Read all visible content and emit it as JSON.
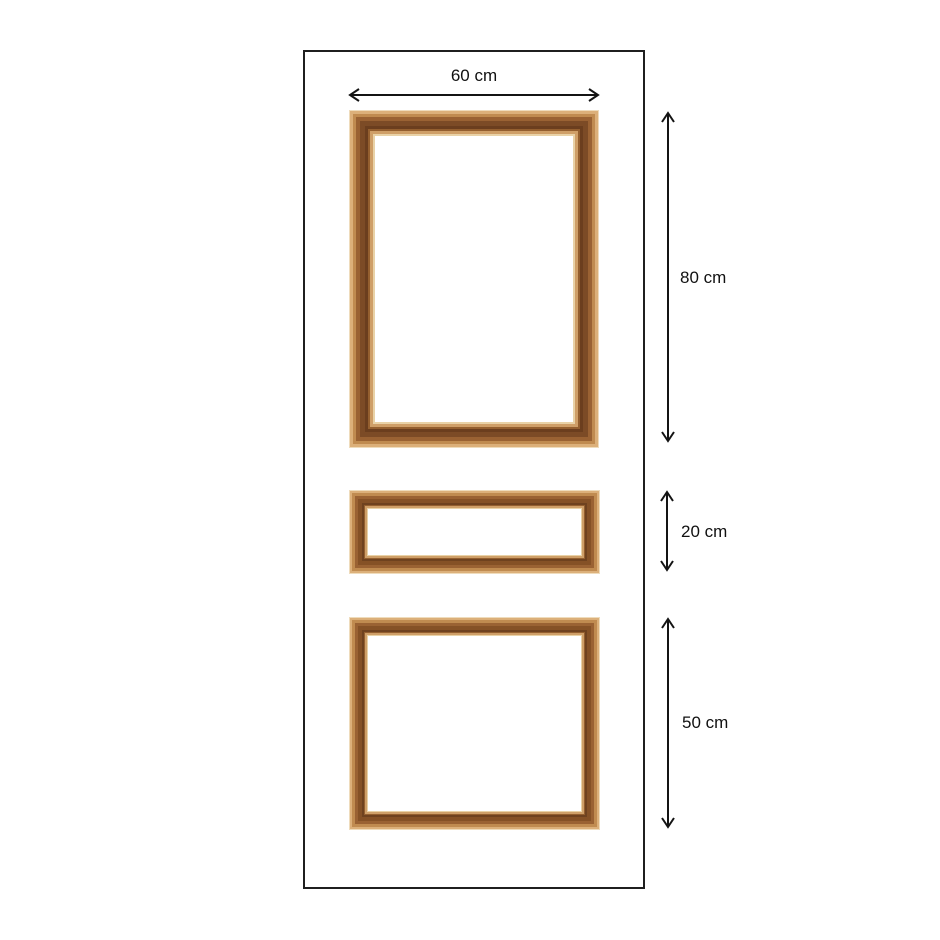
{
  "labels": {
    "top_width": "60 cm",
    "top_frame_height": "80 cm",
    "middle_frame_height": "20 cm",
    "bottom_frame_height": "50 cm"
  },
  "colors": {
    "background": "#ffffff",
    "door_outline": "#1f1f1f",
    "arrow": "#141414",
    "text": "#111111",
    "molding_cream": "#efdcbc",
    "molding_light_tan": "#dcb07a",
    "molding_tan": "#c08b50",
    "molding_brown": "#9a6233",
    "molding_dark_brown": "#7c4b26",
    "molding_darkest_brown": "#6b3e1e",
    "molding_inner_highlight": "#cf9f68"
  }
}
